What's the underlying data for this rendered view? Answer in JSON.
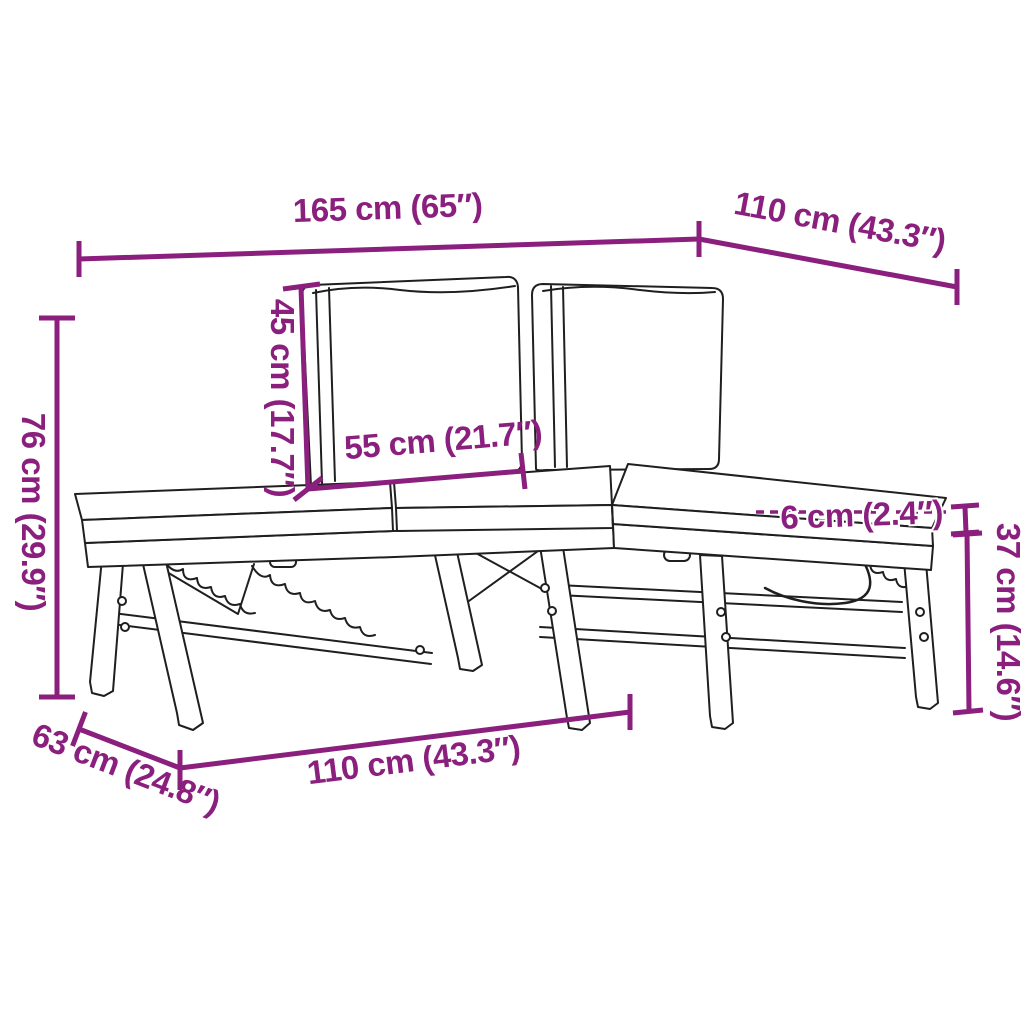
{
  "colors": {
    "dimension_accent": "#8A1F7E",
    "line_art": "#1F1F1F",
    "background": "#FFFFFF"
  },
  "drawing": {
    "subject": "Folding L-shaped garden bench with seat and back cushions",
    "style": "black outline technical sketch on white background"
  },
  "dimensions": {
    "overall_width": {
      "label": "165 cm (65″)",
      "location": "top"
    },
    "extension_length": {
      "label": "110 cm (43.3″)",
      "location": "top-right diagonal"
    },
    "overall_height": {
      "label": "76 cm (29.9″)",
      "location": "left vertical"
    },
    "back_cushion_height": {
      "label": "45 cm (17.7″)",
      "location": "center-left vertical"
    },
    "back_cushion_width": {
      "label": "55 cm (21.7″)",
      "location": "center horizontal"
    },
    "cushion_thickness": {
      "label": "6 cm (2.4″)",
      "location": "right of center"
    },
    "seat_height": {
      "label": "37 cm (14.6″)",
      "location": "right vertical"
    },
    "bench_depth": {
      "label": "63 cm (24.8″)",
      "location": "bottom-left diagonal"
    },
    "seat_section_length": {
      "label": "110 cm (43.3″)",
      "location": "bottom"
    }
  }
}
